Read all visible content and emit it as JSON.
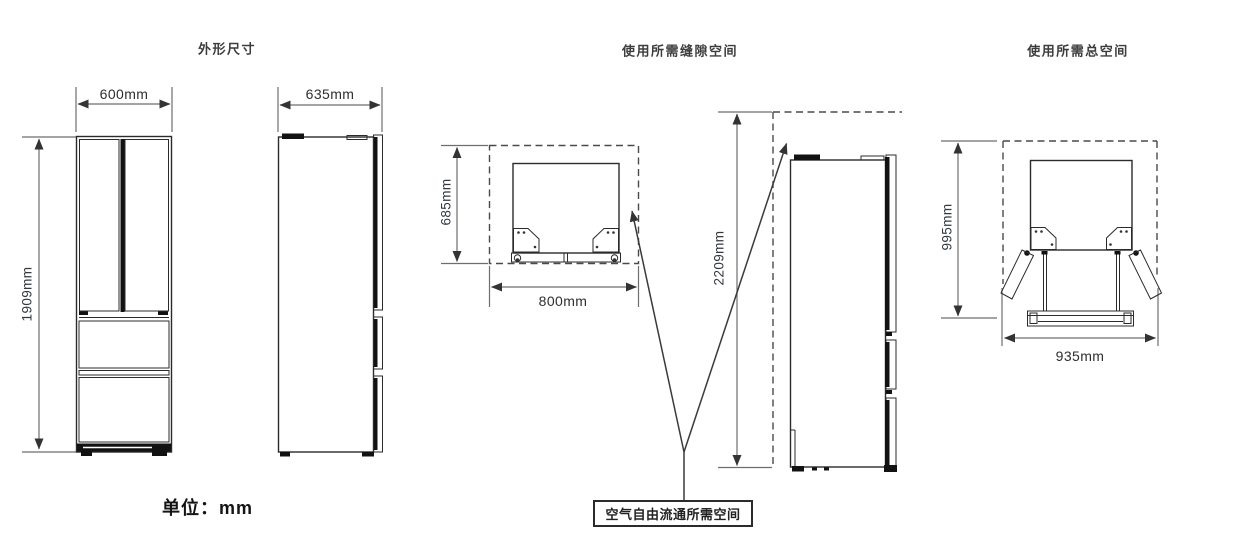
{
  "sections": {
    "outline": {
      "title": "外形尺寸"
    },
    "clearance": {
      "title": "使用所需缝隙空间"
    },
    "total": {
      "title": "使用所需总空间"
    }
  },
  "dims": {
    "width": "600mm",
    "depth": "635mm",
    "height": "1909mm",
    "clearance_depth": "685mm",
    "clearance_width": "800mm",
    "clearance_height": "2209mm",
    "total_depth": "995mm",
    "total_width": "935mm"
  },
  "notes": {
    "unit": "单位：mm",
    "air_circulation": "空气自由流通所需空间"
  },
  "colors": {
    "line": "#2b2b2b",
    "dim_line": "#6e6e6e",
    "text": "#333333",
    "background": "#ffffff"
  }
}
